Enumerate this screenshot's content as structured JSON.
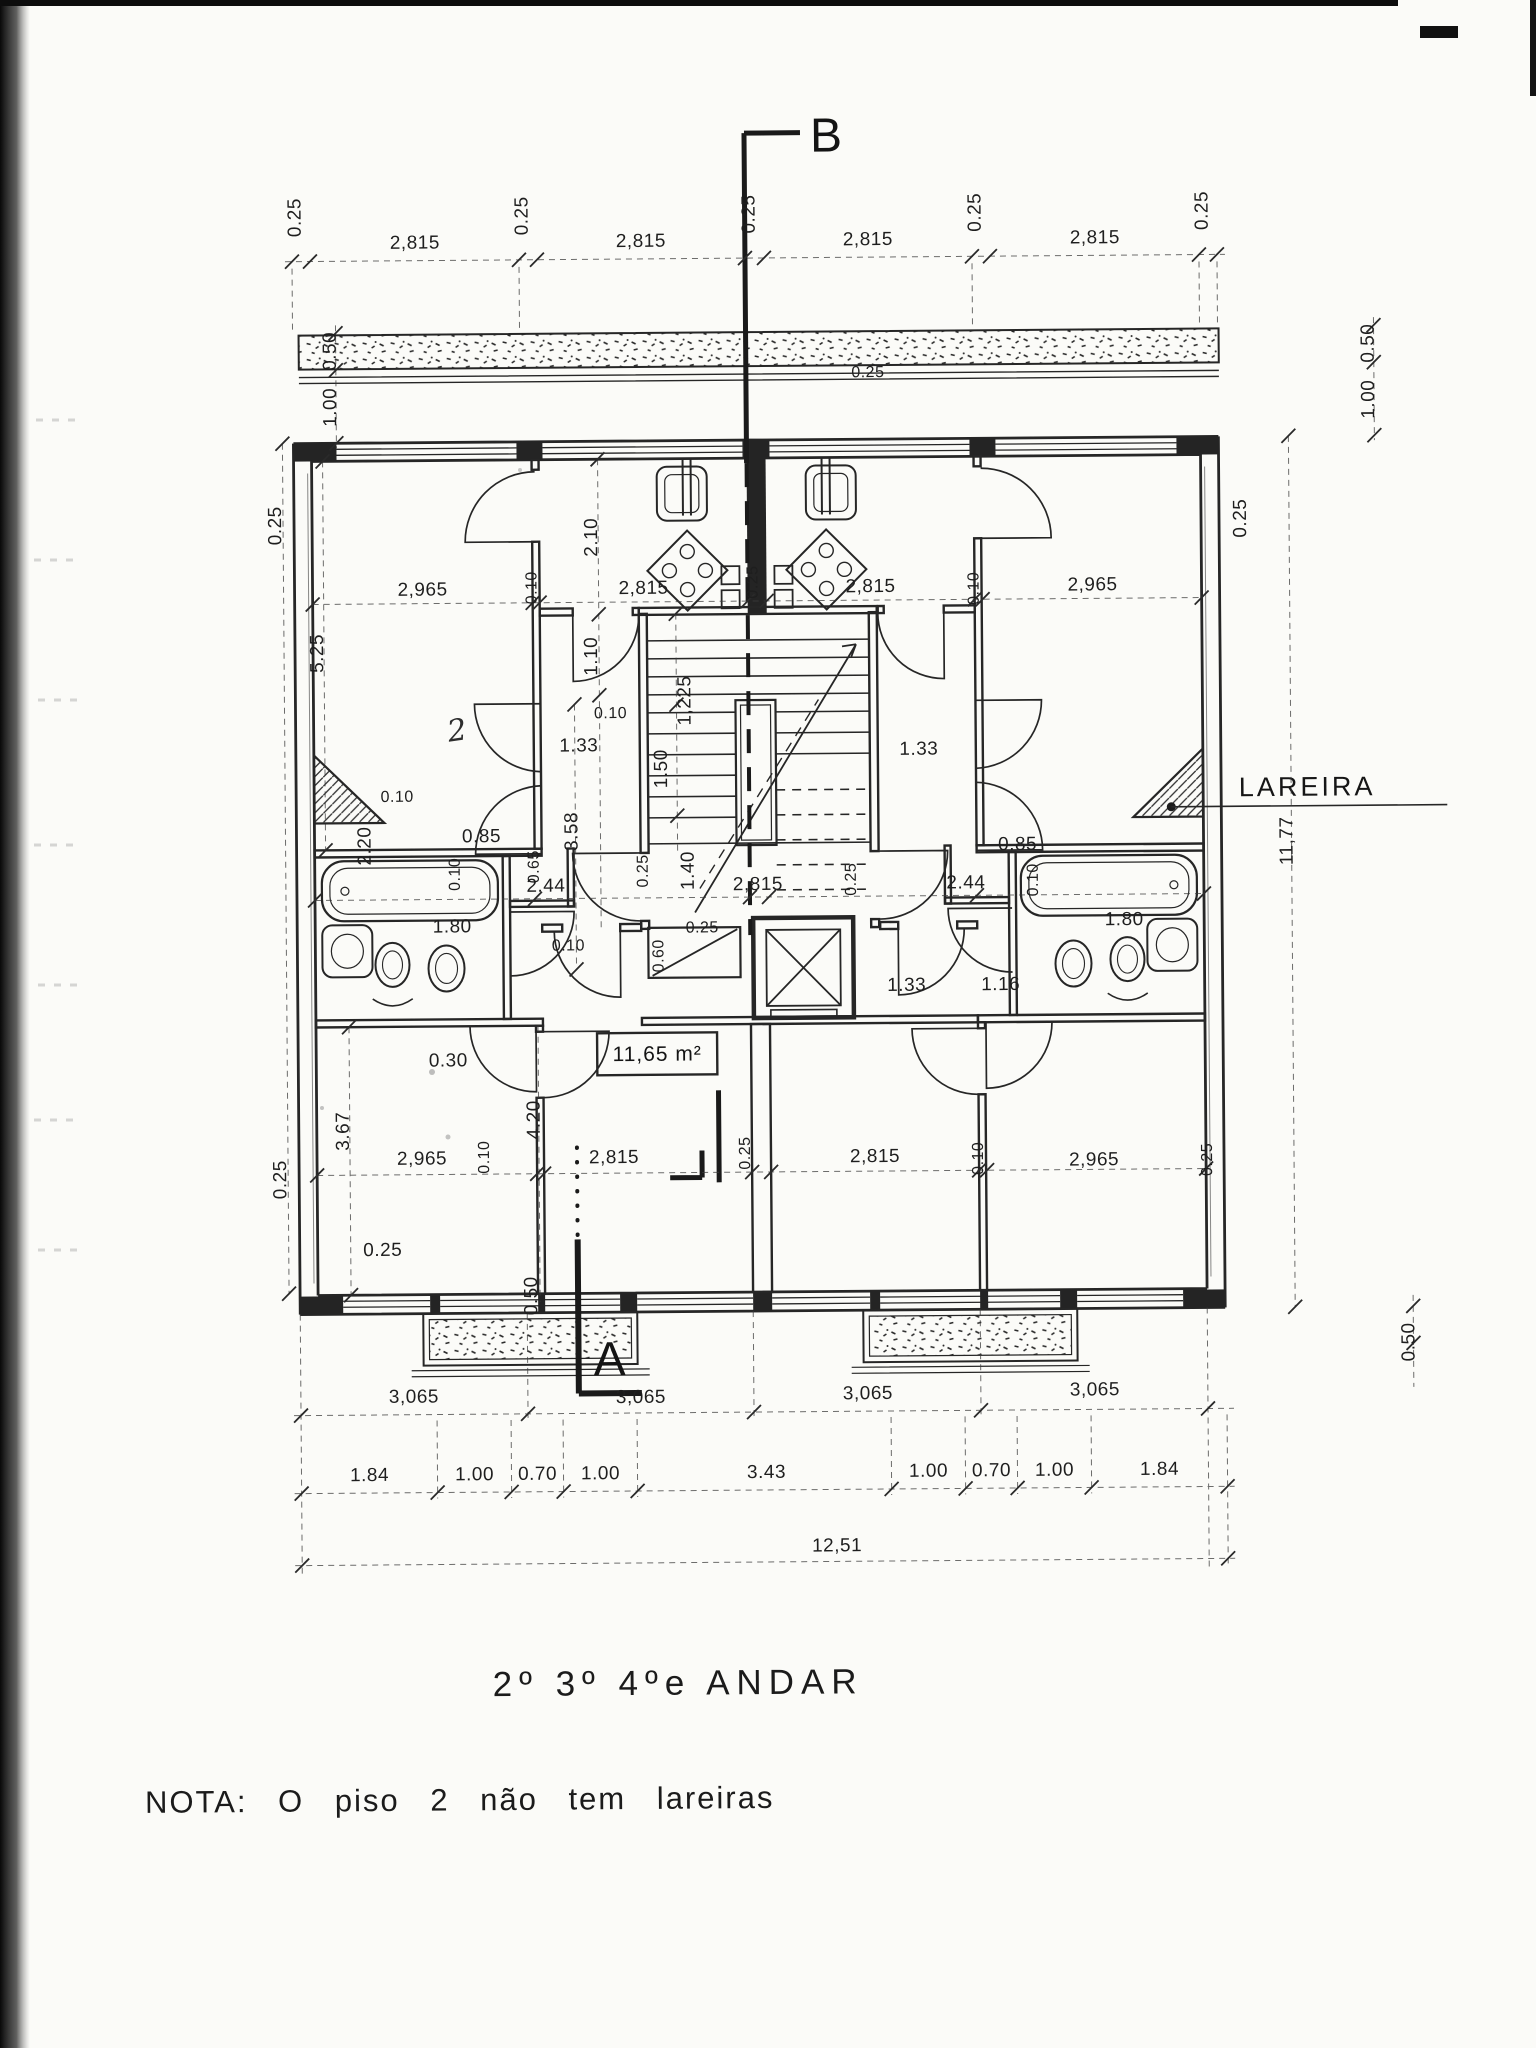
{
  "title": "2º 3º 4ºe ANDAR",
  "note": "NOTA: O piso 2 não tem lareiras",
  "markers": {
    "top_section": "B",
    "bottom_section": "A"
  },
  "callouts": {
    "fireplace": "LAREIRA",
    "room_area": "11,65 m²",
    "hand_mark": "2"
  },
  "ink_color": "#262626",
  "paper_color": "#fbfbf8",
  "dim_labels": [
    {
      "t": "0.25",
      "x": 306,
      "y": 214,
      "r": 1
    },
    {
      "t": "2,815",
      "x": 420,
      "y": 246
    },
    {
      "t": "0.25",
      "x": 533,
      "y": 214,
      "r": 1
    },
    {
      "t": "2,815",
      "x": 646,
      "y": 246
    },
    {
      "t": "0.25",
      "x": 760,
      "y": 214,
      "r": 1
    },
    {
      "t": "2,815",
      "x": 873,
      "y": 246
    },
    {
      "t": "0.25",
      "x": 986,
      "y": 214,
      "r": 1
    },
    {
      "t": "2,815",
      "x": 1100,
      "y": 246
    },
    {
      "t": "0.25",
      "x": 1213,
      "y": 214,
      "r": 1
    },
    {
      "t": "0.50",
      "x": 340,
      "y": 348,
      "r": 1
    },
    {
      "t": "1.00",
      "x": 340,
      "y": 404,
      "r": 1
    },
    {
      "t": "0.25",
      "x": 284,
      "y": 522,
      "r": 1
    },
    {
      "t": "5.25",
      "x": 325,
      "y": 650,
      "r": 1
    },
    {
      "t": "2.20",
      "x": 371,
      "y": 843,
      "r": 1
    },
    {
      "t": "1.80",
      "x": 452,
      "y": 930
    },
    {
      "t": "0.30",
      "x": 447,
      "y": 1064
    },
    {
      "t": "3.67",
      "x": 347,
      "y": 1128,
      "r": 1
    },
    {
      "t": "0.25",
      "x": 284,
      "y": 1176,
      "r": 1
    },
    {
      "t": "0.25",
      "x": 380,
      "y": 1253
    },
    {
      "t": "0.50",
      "x": 1378,
      "y": 348,
      "r": 1
    },
    {
      "t": "1.00",
      "x": 1378,
      "y": 404,
      "r": 1
    },
    {
      "t": "0.25",
      "x": 1249,
      "y": 522,
      "r": 1
    },
    {
      "t": "11,77",
      "x": 1293,
      "y": 845,
      "r": 1
    },
    {
      "t": "0.50",
      "x": 1411,
      "y": 1347,
      "r": 1
    },
    {
      "t": "2,965",
      "x": 425,
      "y": 593
    },
    {
      "t": "0.10",
      "x": 539,
      "y": 586,
      "r": 1,
      "s": 1
    },
    {
      "t": "2,815",
      "x": 646,
      "y": 593
    },
    {
      "t": "0.25",
      "x": 760,
      "y": 582,
      "r": 1,
      "s": 1
    },
    {
      "t": "2,815",
      "x": 873,
      "y": 593
    },
    {
      "t": "0.10",
      "x": 981,
      "y": 590,
      "r": 1,
      "s": 1
    },
    {
      "t": "2,965",
      "x": 1095,
      "y": 593
    },
    {
      "t": "0.25",
      "x": 872,
      "y": 378,
      "s": 1
    },
    {
      "t": "2.10",
      "x": 600,
      "y": 536,
      "r": 1
    },
    {
      "t": "1.10",
      "x": 599,
      "y": 655,
      "r": 1
    },
    {
      "t": "1,225",
      "x": 692,
      "y": 700,
      "r": 1
    },
    {
      "t": "1.50",
      "x": 668,
      "y": 768,
      "r": 1
    },
    {
      "t": "0.10",
      "x": 612,
      "y": 717,
      "s": 1
    },
    {
      "t": "1.33",
      "x": 580,
      "y": 750
    },
    {
      "t": "1.33",
      "x": 920,
      "y": 756
    },
    {
      "t": "3.58",
      "x": 578,
      "y": 830,
      "r": 1
    },
    {
      "t": "0.25",
      "x": 648,
      "y": 870,
      "r": 1,
      "s": 1
    },
    {
      "t": "1.40",
      "x": 694,
      "y": 870,
      "r": 1
    },
    {
      "t": "2,815",
      "x": 758,
      "y": 890
    },
    {
      "t": "0.25",
      "x": 856,
      "y": 880,
      "r": 1,
      "s": 1
    },
    {
      "t": "2.44",
      "x": 966,
      "y": 890
    },
    {
      "t": "0.85",
      "x": 1018,
      "y": 852
    },
    {
      "t": "0.10",
      "x": 1038,
      "y": 882,
      "r": 1,
      "s": 1
    },
    {
      "t": "1.80",
      "x": 1124,
      "y": 928
    },
    {
      "t": "0.10",
      "x": 398,
      "y": 799,
      "s": 1
    },
    {
      "t": "0.85",
      "x": 482,
      "y": 840
    },
    {
      "t": "0.65",
      "x": 539,
      "y": 865,
      "r": 1,
      "s": 1
    },
    {
      "t": "0.10",
      "x": 460,
      "y": 872,
      "r": 1,
      "s": 1
    },
    {
      "t": "2.44",
      "x": 546,
      "y": 890
    },
    {
      "t": "0.10",
      "x": 568,
      "y": 949,
      "s": 1
    },
    {
      "t": "0.60",
      "x": 663,
      "y": 955,
      "r": 1,
      "s": 1
    },
    {
      "t": "0.25",
      "x": 702,
      "y": 932,
      "s": 1
    },
    {
      "t": "1.33",
      "x": 906,
      "y": 992
    },
    {
      "t": "1.16",
      "x": 1000,
      "y": 992
    },
    {
      "t": "4.20",
      "x": 538,
      "y": 1118,
      "r": 1
    },
    {
      "t": "2,965",
      "x": 420,
      "y": 1162
    },
    {
      "t": "0.10",
      "x": 487,
      "y": 1155,
      "r": 1,
      "s": 1
    },
    {
      "t": "2,815",
      "x": 612,
      "y": 1162
    },
    {
      "t": "0.25",
      "x": 748,
      "y": 1153,
      "r": 1,
      "s": 1
    },
    {
      "t": "2,815",
      "x": 873,
      "y": 1163
    },
    {
      "t": "0.10",
      "x": 981,
      "y": 1160,
      "r": 1,
      "s": 1
    },
    {
      "t": "2,965",
      "x": 1092,
      "y": 1168
    },
    {
      "t": "0.25",
      "x": 1210,
      "y": 1163,
      "r": 1,
      "s": 1
    },
    {
      "t": "0.50",
      "x": 534,
      "y": 1294,
      "r": 1
    },
    {
      "t": "3,065",
      "x": 410,
      "y": 1400
    },
    {
      "t": "3,065",
      "x": 637,
      "y": 1402
    },
    {
      "t": "3,065",
      "x": 864,
      "y": 1400
    },
    {
      "t": "3,065",
      "x": 1091,
      "y": 1398
    },
    {
      "t": "1.84",
      "x": 365,
      "y": 1478
    },
    {
      "t": "1.00",
      "x": 470,
      "y": 1478
    },
    {
      "t": "0.70",
      "x": 533,
      "y": 1478
    },
    {
      "t": "1.00",
      "x": 596,
      "y": 1478
    },
    {
      "t": "3.43",
      "x": 762,
      "y": 1478
    },
    {
      "t": "1.00",
      "x": 924,
      "y": 1478
    },
    {
      "t": "0.70",
      "x": 987,
      "y": 1478
    },
    {
      "t": "1.00",
      "x": 1050,
      "y": 1478
    },
    {
      "t": "1.84",
      "x": 1155,
      "y": 1478
    },
    {
      "t": "12,51",
      "x": 832,
      "y": 1552
    }
  ]
}
